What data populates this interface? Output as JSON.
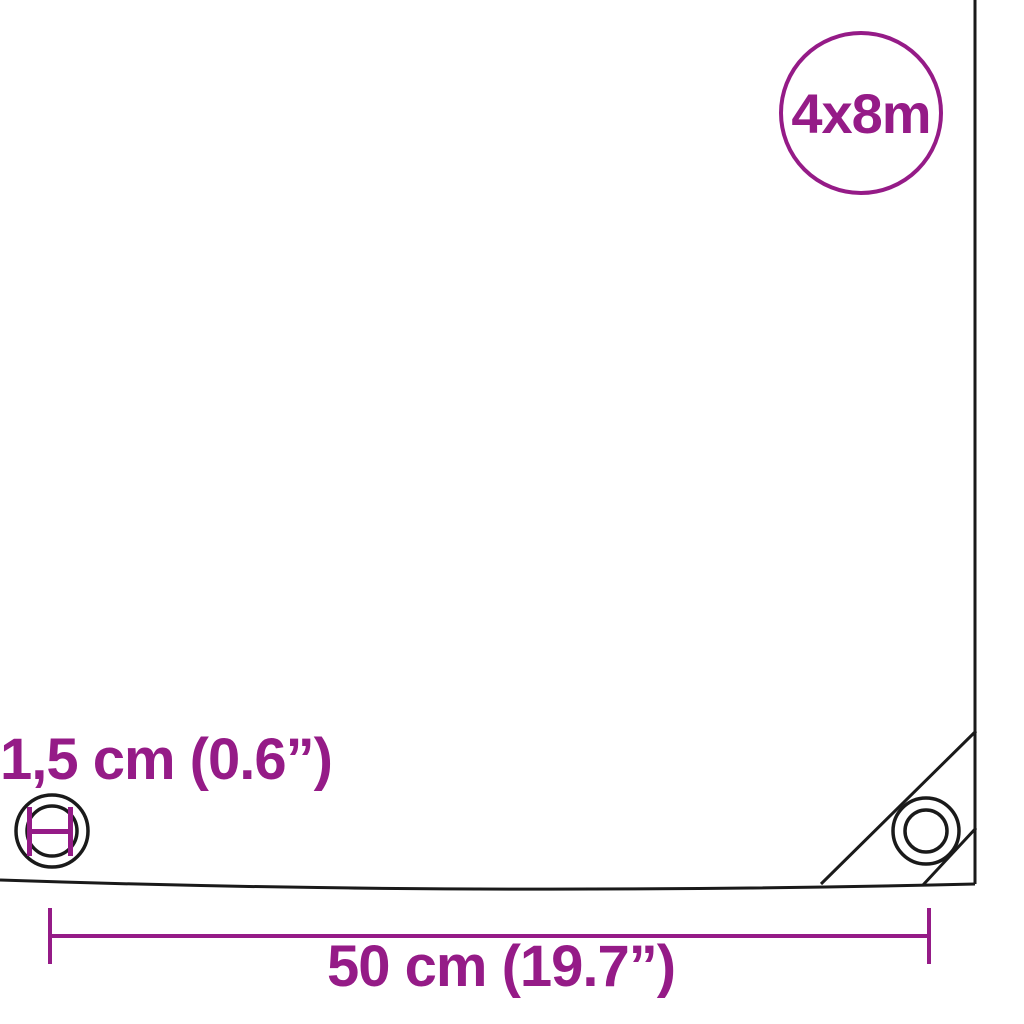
{
  "diagram": {
    "size_badge": {
      "label": "4x8m"
    },
    "eyelet_dimension_label": "1,5 cm (0.6”)",
    "spacing_dimension_label": "50 cm (19.7”)",
    "icon_names": {
      "eyelet_marker": "eyelet-diameter-icon",
      "corner_grommet": "corner-grommet-icon"
    }
  },
  "colors": {
    "accent": "#951b87",
    "line": "#1a1a1a",
    "background": "#ffffff"
  }
}
